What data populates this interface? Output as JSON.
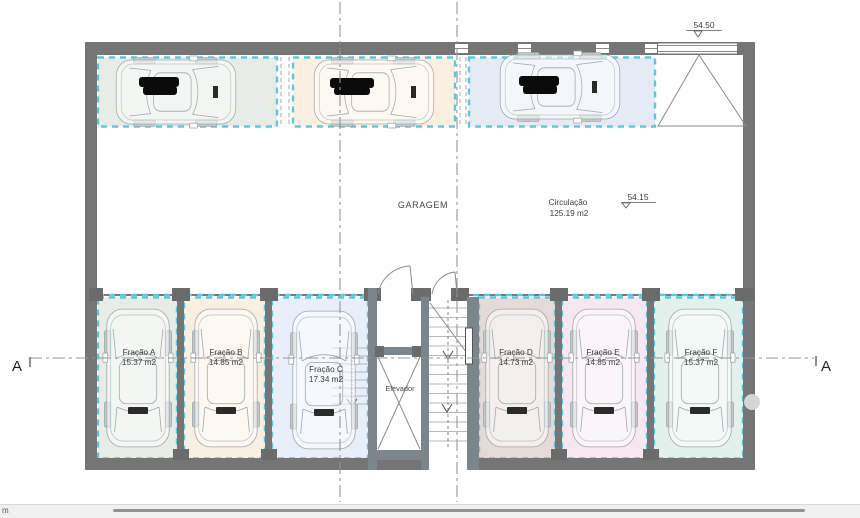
{
  "plan": {
    "garagem_label": "GARAGEM",
    "circulacao": {
      "name": "Circulação",
      "area": "125.19 m2"
    },
    "levels": {
      "ramp": "54.50",
      "floor": "54.15"
    },
    "elevator_label": "Elevador",
    "section_marker_left": "A",
    "section_marker_right": "A",
    "fracoes": [
      {
        "name": "Fração A",
        "area": "15.37 m2"
      },
      {
        "name": "Fração B",
        "area": "14.85 m2"
      },
      {
        "name": "Fração C",
        "area": "17.34 m2"
      },
      {
        "name": "Fração D",
        "area": "14.73 m2"
      },
      {
        "name": "Fração E",
        "area": "14.85 m2"
      },
      {
        "name": "Fração F",
        "area": "15.37 m2"
      }
    ]
  },
  "colors": {
    "wall": "#757575",
    "cyan_dash": "#5ec7dd",
    "space_green": "#e7ece6",
    "space_cream": "#faf0e1",
    "space_blue_top": "#e4ebf5",
    "space_blue": "#e9effa",
    "space_rose": "#e6dad8",
    "space_pink": "#f7e7f0",
    "space_mint": "#e3f1ed"
  },
  "statusbar": {
    "unit_label": "m"
  }
}
